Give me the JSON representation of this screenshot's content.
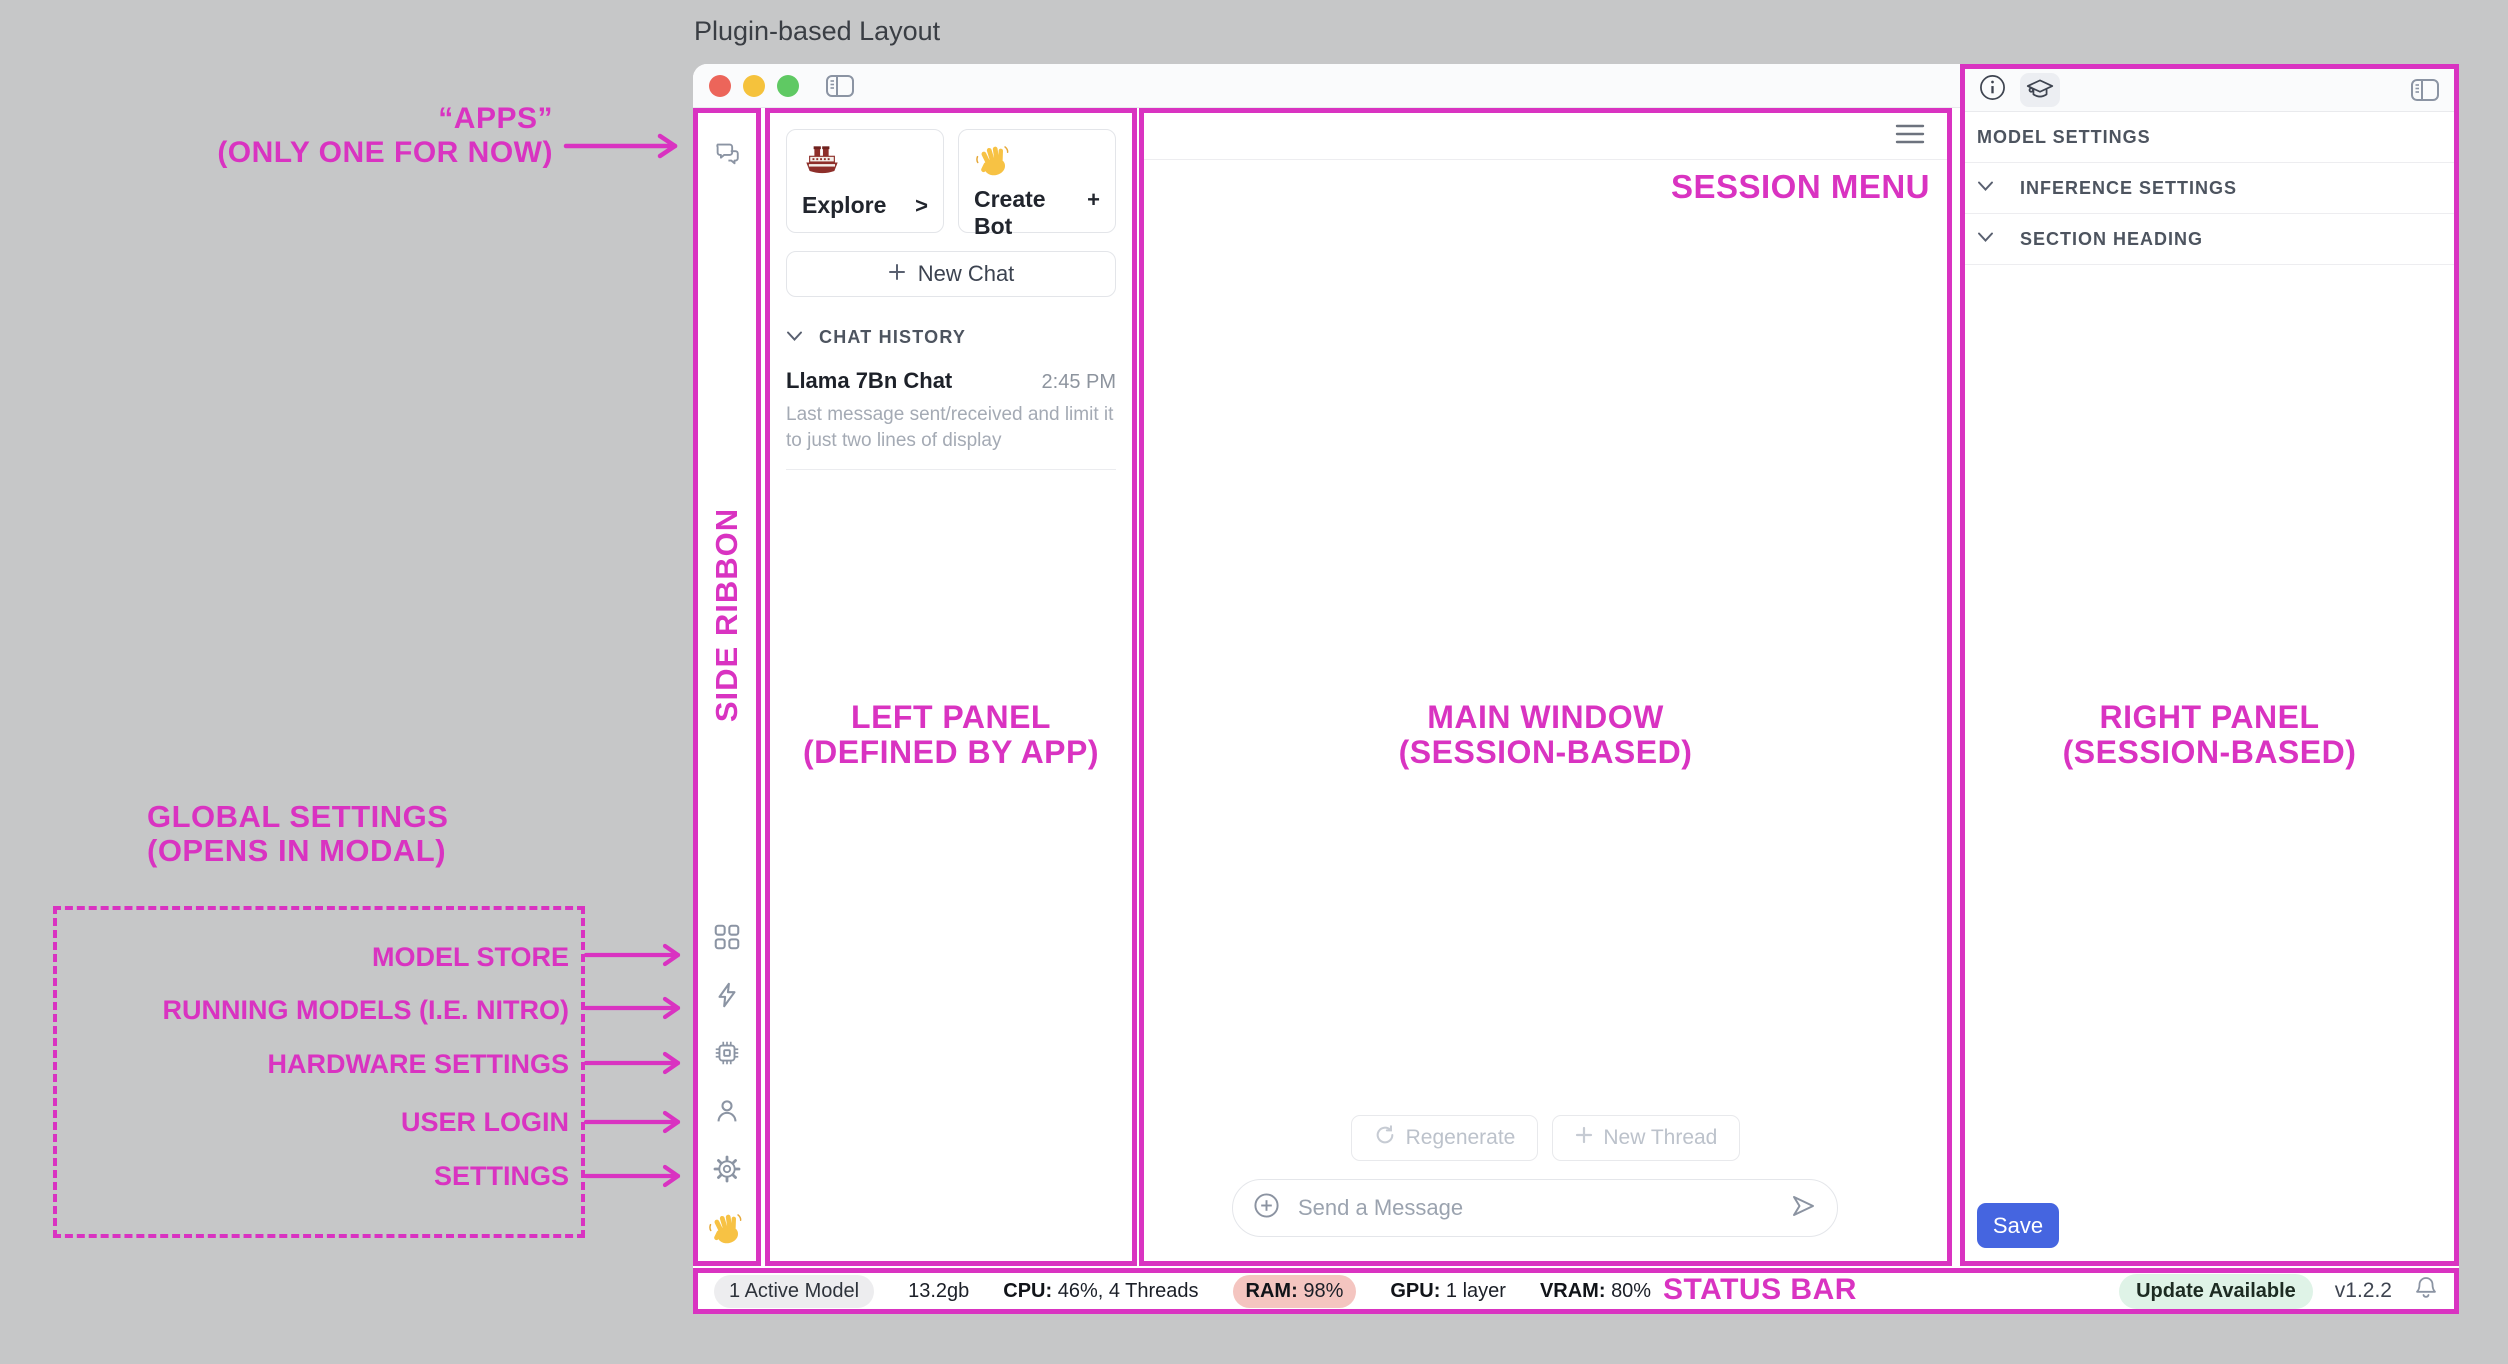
{
  "page_title": "Plugin-based Layout",
  "annotations": {
    "apps_line1": "“APPS”",
    "apps_line2": "(ONLY ONE FOR NOW)",
    "side_ribbon": "SIDE RIBBON",
    "left_panel_line1": "LEFT PANEL",
    "left_panel_line2": "(DEFINED BY APP)",
    "main_window_line1": "MAIN WINDOW",
    "main_window_line2": "(SESSION-BASED)",
    "right_panel_line1": "RIGHT PANEL",
    "right_panel_line2": "(SESSION-BASED)",
    "session_menu": "SESSION MENU",
    "status_bar": "STATUS BAR",
    "global_settings_line1": "GLOBAL SETTINGS",
    "global_settings_line2": "(OPENS IN MODAL)",
    "global_items": [
      {
        "label": "MODEL STORE"
      },
      {
        "label": "RUNNING MODELS (I.E. NITRO)"
      },
      {
        "label": "HARDWARE SETTINGS"
      },
      {
        "label": "USER LOGIN"
      },
      {
        "label": "SETTINGS"
      }
    ]
  },
  "left_panel": {
    "cards": [
      {
        "icon": "ship-emoji",
        "label": "Explore",
        "action": ">"
      },
      {
        "icon": "wave-emoji",
        "label": "Create Bot",
        "action": "+"
      }
    ],
    "new_chat_label": "New Chat",
    "chat_history_header": "CHAT HISTORY",
    "chat_item": {
      "title": "Llama 7Bn Chat",
      "time": "2:45 PM",
      "preview": "Last message sent/received and limit it to just two lines of display"
    }
  },
  "main_window": {
    "regenerate_label": "Regenerate",
    "new_thread_label": "New Thread",
    "composer_placeholder": "Send a Message"
  },
  "right_panel": {
    "section_title": "MODEL SETTINGS",
    "sections": [
      {
        "label": "INFERENCE SETTINGS"
      },
      {
        "label": "SECTION HEADING"
      }
    ],
    "save_label": "Save"
  },
  "status_bar": {
    "active_model": "1 Active Model",
    "memory": "13.2gb",
    "cpu_label": "CPU:",
    "cpu_value": "46%, 4 Threads",
    "ram_label": "RAM:",
    "ram_value": "98%",
    "gpu_label": "GPU:",
    "gpu_value": "1 layer",
    "vram_label": "VRAM:",
    "vram_value": "80%",
    "update_badge": "Update Available",
    "version": "v1.2.2"
  },
  "colors": {
    "accent_pink": "#d933c1",
    "save_blue": "#4565e0",
    "ram_warning_bg": "#f4c5c0",
    "update_badge_bg": "#dff3e7"
  }
}
